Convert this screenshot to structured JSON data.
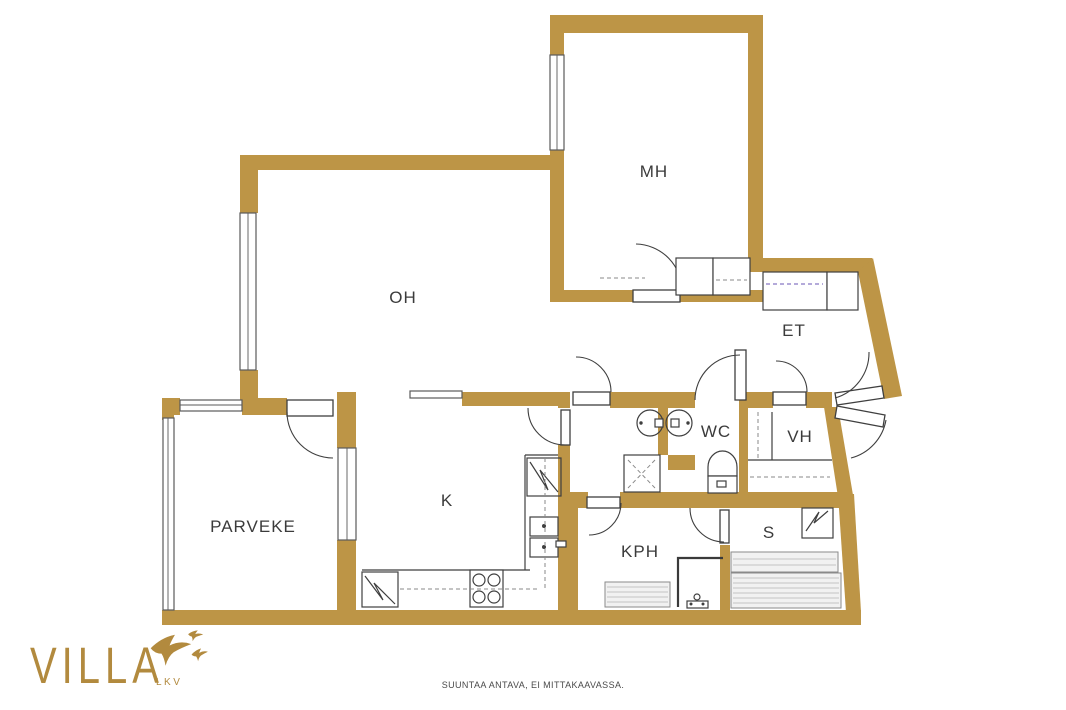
{
  "plan": {
    "rooms": [
      {
        "id": "oh",
        "label": "OH"
      },
      {
        "id": "mh",
        "label": "MH"
      },
      {
        "id": "et",
        "label": "ET"
      },
      {
        "id": "k",
        "label": "K"
      },
      {
        "id": "parveke",
        "label": "PARVEKE"
      },
      {
        "id": "kph",
        "label": "KPH"
      },
      {
        "id": "wc",
        "label": "WC"
      },
      {
        "id": "vh",
        "label": "VH"
      },
      {
        "id": "s",
        "label": "S"
      }
    ],
    "fixtures": [
      "door-arc",
      "window",
      "closet",
      "wardrobe-rail",
      "sink-icon",
      "toilet-icon",
      "shower-icon",
      "shower-mixer-icon",
      "sauna-heater-icon",
      "sauna-bench",
      "stove-icon",
      "fridge-icon",
      "kitchen-counter",
      "appliance-icon"
    ],
    "colors": {
      "wall": "#BD9546",
      "label": "#3B3B3B",
      "fixture_line": "#3F3F3F",
      "closet_dash": "#8878C3",
      "bench_fill": "#F1F1F1"
    }
  },
  "branding": {
    "logo_text": "VILLA",
    "logo_sub": "LKV",
    "logo_color": "#B28A3E"
  },
  "footer": {
    "disclaimer": "SUUNTAA ANTAVA, EI MITTAKAAVASSA."
  }
}
